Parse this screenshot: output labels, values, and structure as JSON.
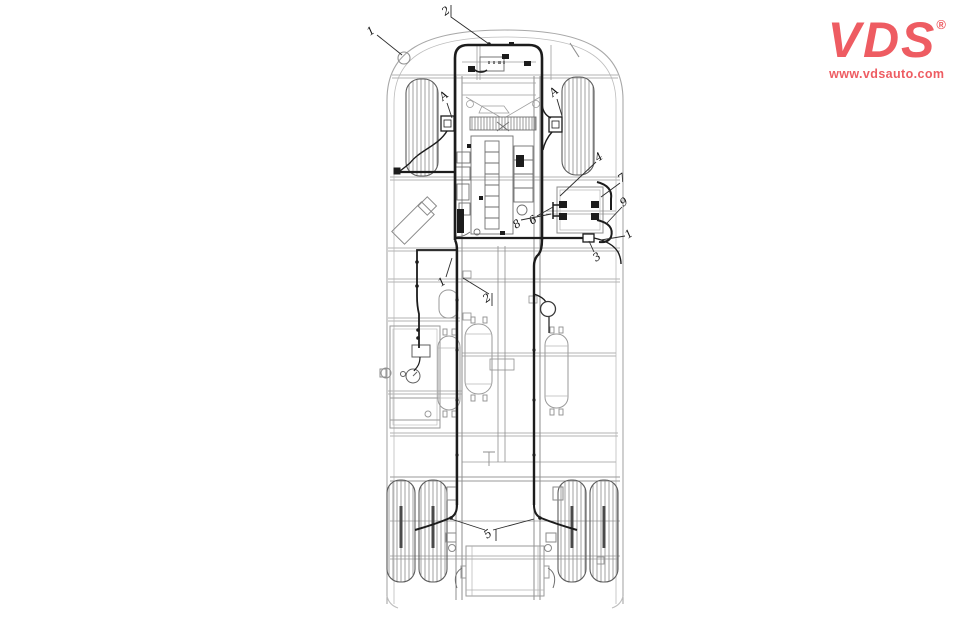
{
  "brand": {
    "name": "VDS",
    "registered": "®",
    "website": "www.vdsauto.com",
    "color": "#ee5c62"
  },
  "diagram": {
    "callouts": [
      {
        "label": "1"
      },
      {
        "label": "2"
      },
      {
        "label": "A"
      },
      {
        "label": "A"
      },
      {
        "label": "4"
      },
      {
        "label": "7"
      },
      {
        "label": "9"
      },
      {
        "label": "1"
      },
      {
        "label": "3"
      },
      {
        "label": "8"
      },
      {
        "label": "6"
      },
      {
        "label": "1"
      },
      {
        "label": "2"
      },
      {
        "label": "5"
      }
    ]
  },
  "colors": {
    "brand_red": "#ee5c62",
    "harness_black": "#1c1c1c",
    "body_gray": "#a8a8a8"
  }
}
